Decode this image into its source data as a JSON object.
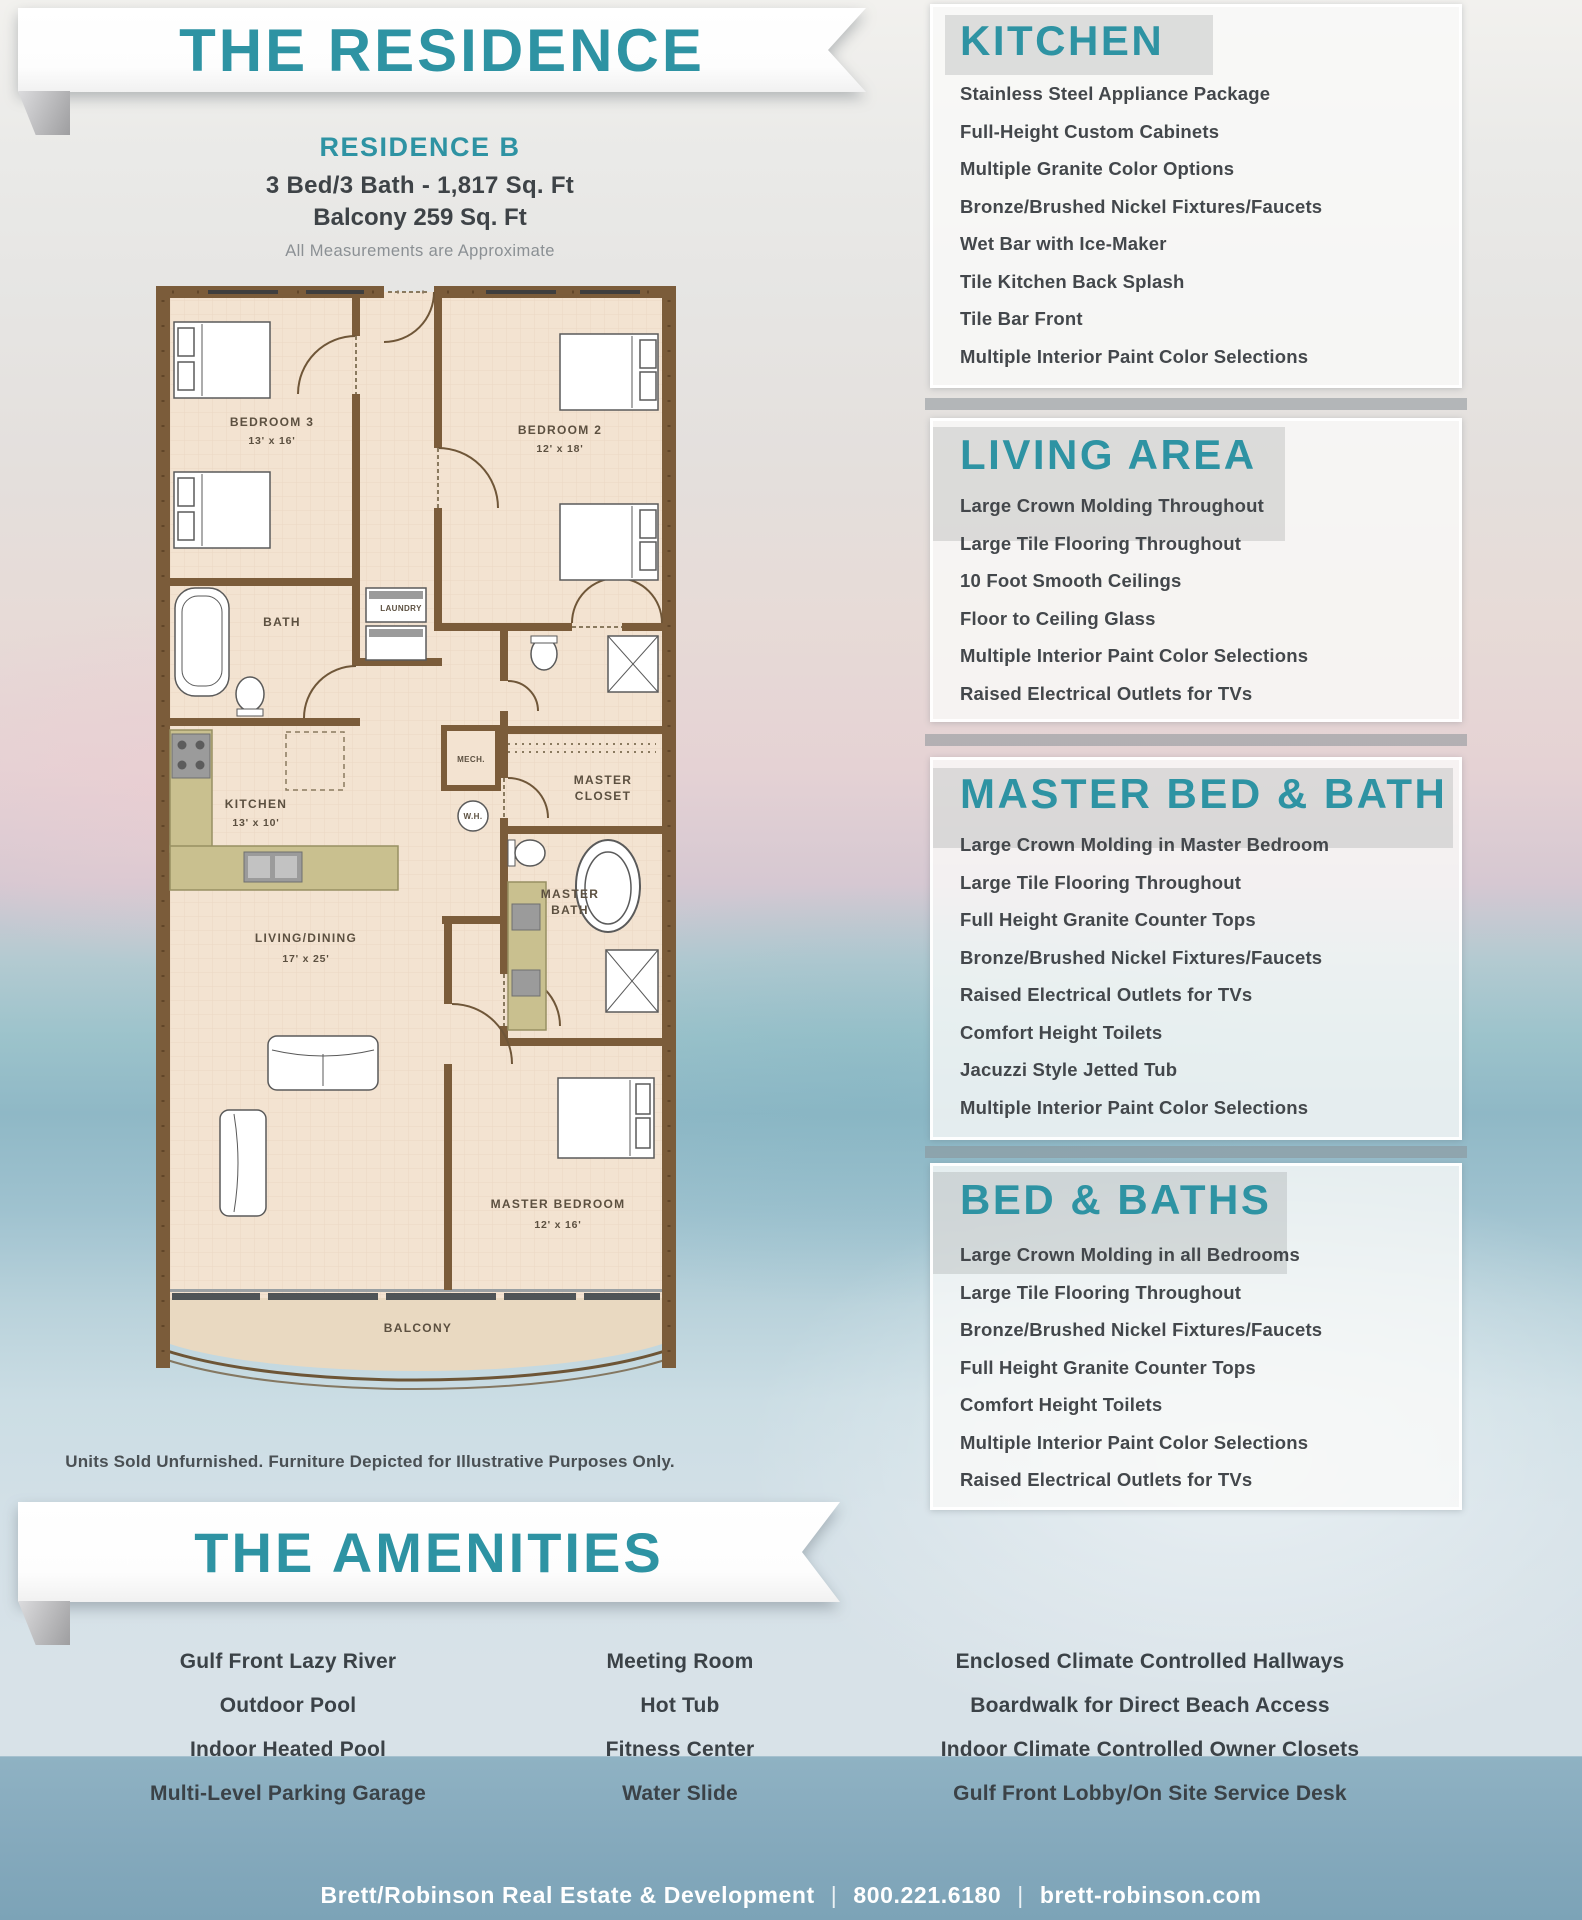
{
  "banners": {
    "residence": "THE RESIDENCE",
    "amenities": "THE AMENITIES"
  },
  "residence_info": {
    "name": "RESIDENCE B",
    "specs": "3 Bed/3 Bath - 1,817 Sq. Ft",
    "balcony": "Balcony 259 Sq. Ft",
    "note": "All Measurements are Approximate"
  },
  "floorplan": {
    "disclaimer": "Units Sold Unfurnished. Furniture Depicted for Illustrative Purposes Only.",
    "rooms": {
      "bedroom3": {
        "lines": [
          "BEDROOM 3",
          "13' x 16'"
        ]
      },
      "bedroom2": {
        "lines": [
          "BEDROOM 2",
          "12' x 18'"
        ]
      },
      "bath": {
        "lines": [
          "BATH"
        ]
      },
      "laundry": {
        "lines": [
          "LAUNDRY"
        ]
      },
      "kitchen": {
        "lines": [
          "KITCHEN",
          "13' x 10'"
        ]
      },
      "mech": {
        "lines": [
          "MECH."
        ]
      },
      "wh": {
        "lines": [
          "W.H."
        ]
      },
      "master_closet": {
        "lines": [
          "MASTER",
          "CLOSET"
        ]
      },
      "master_bath": {
        "lines": [
          "MASTER",
          "BATH"
        ]
      },
      "living": {
        "lines": [
          "LIVING/DINING",
          "17' x 25'"
        ]
      },
      "master_bedroom": {
        "lines": [
          "MASTER BEDROOM",
          "12' x 16'"
        ]
      },
      "balcony": {
        "lines": [
          "BALCONY"
        ]
      }
    }
  },
  "panels": [
    {
      "title": "KITCHEN",
      "items": [
        "Stainless Steel Appliance Package",
        "Full-Height Custom Cabinets",
        "Multiple Granite Color Options",
        "Bronze/Brushed Nickel Fixtures/Faucets",
        "Wet Bar with Ice-Maker",
        "Tile Kitchen Back Splash",
        "Tile Bar Front",
        "Multiple Interior Paint Color Selections"
      ]
    },
    {
      "title": "LIVING AREA",
      "items": [
        "Large Crown Molding Throughout",
        "Large Tile Flooring Throughout",
        "10 Foot Smooth Ceilings",
        "Floor to Ceiling Glass",
        "Multiple Interior Paint Color Selections",
        "Raised Electrical Outlets for TVs"
      ]
    },
    {
      "title": "MASTER BED & BATH",
      "items": [
        "Large Crown Molding in Master Bedroom",
        "Large Tile Flooring Throughout",
        "Full Height Granite Counter Tops",
        "Bronze/Brushed Nickel Fixtures/Faucets",
        "Raised Electrical Outlets for TVs",
        "Comfort Height Toilets",
        "Jacuzzi Style Jetted Tub",
        "Multiple Interior Paint Color Selections"
      ]
    },
    {
      "title": "BED & BATHS",
      "items": [
        "Large Crown Molding in all Bedrooms",
        "Large Tile Flooring Throughout",
        "Bronze/Brushed Nickel Fixtures/Faucets",
        "Full Height Granite Counter Tops",
        "Comfort Height Toilets",
        "Multiple Interior Paint Color Selections",
        "Raised Electrical Outlets for TVs"
      ]
    }
  ],
  "amenities": {
    "columns": [
      [
        "Gulf Front Lazy River",
        "Outdoor Pool",
        "Indoor Heated Pool",
        "Multi-Level Parking Garage"
      ],
      [
        "Meeting Room",
        "Hot Tub",
        "Fitness Center",
        "Water Slide"
      ],
      [
        "Enclosed Climate Controlled Hallways",
        "Boardwalk for Direct Beach Access",
        "Indoor Climate Controlled Owner Closets",
        "Gulf Front Lobby/On Site Service Desk"
      ]
    ]
  },
  "footer": {
    "company": "Brett/Robinson Real Estate & Development",
    "phone": "800.221.6180",
    "website": "brett-robinson.com",
    "separator": "|"
  },
  "colors": {
    "teal_heading": "#2e93a3",
    "feature_text": "#43474b",
    "wall_brown": "#7b5c3a",
    "floor_tan": "#f3e3d1",
    "counter_olive": "#c9c08f",
    "balcony_tan": "#e9d9c1",
    "footer_band_blue": "#84a9bd",
    "footer_text": "#ffffff"
  }
}
